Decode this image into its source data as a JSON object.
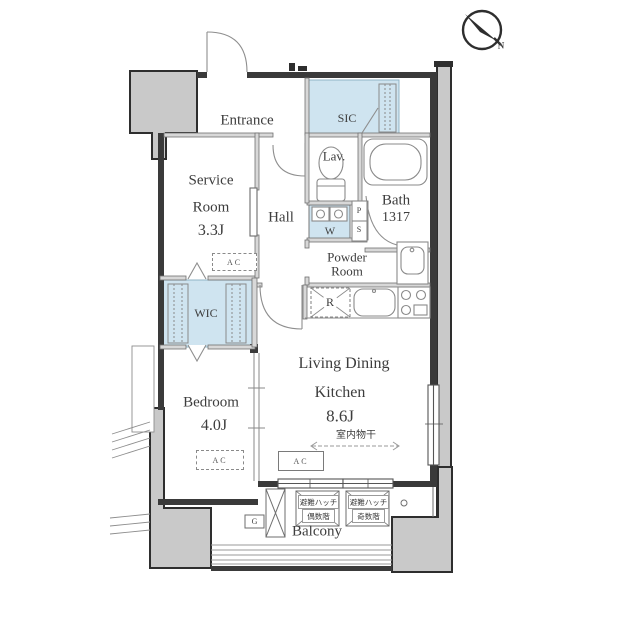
{
  "compass": {
    "north": "N"
  },
  "labels": {
    "ac": "AC"
  },
  "rooms": {
    "entrance": "Entrance",
    "sic": "SIC",
    "service_room": {
      "l1": "Service",
      "l2": "Room",
      "size": "3.3J"
    },
    "hall": "Hall",
    "lavatory": "Lav.",
    "washer": "W",
    "pipe_shaft": {
      "p": "P",
      "s": "S"
    },
    "bath": {
      "name": "Bath",
      "size": "1317"
    },
    "powder_room": {
      "l1": "Powder",
      "l2": "Room"
    },
    "wic": "WIC",
    "refrigerator": "R",
    "ldk": {
      "l1": "Living Dining",
      "l2": "Kitchen",
      "size": "8.6J"
    },
    "indoor_drying": "室内物干",
    "bedroom": {
      "name": "Bedroom",
      "size": "4.0J"
    },
    "balcony": {
      "name": "Balcony",
      "gas": "G",
      "hatch_even": {
        "l1": "避難ハッチ",
        "l2": "偶数階"
      },
      "hatch_odd": {
        "l1": "避難ハッチ",
        "l2": "奇数階"
      }
    }
  },
  "colors": {
    "closet_fill": "#cfe4f0",
    "structure_fill": "#c9c9c9",
    "wall": "#3a3a3a"
  }
}
